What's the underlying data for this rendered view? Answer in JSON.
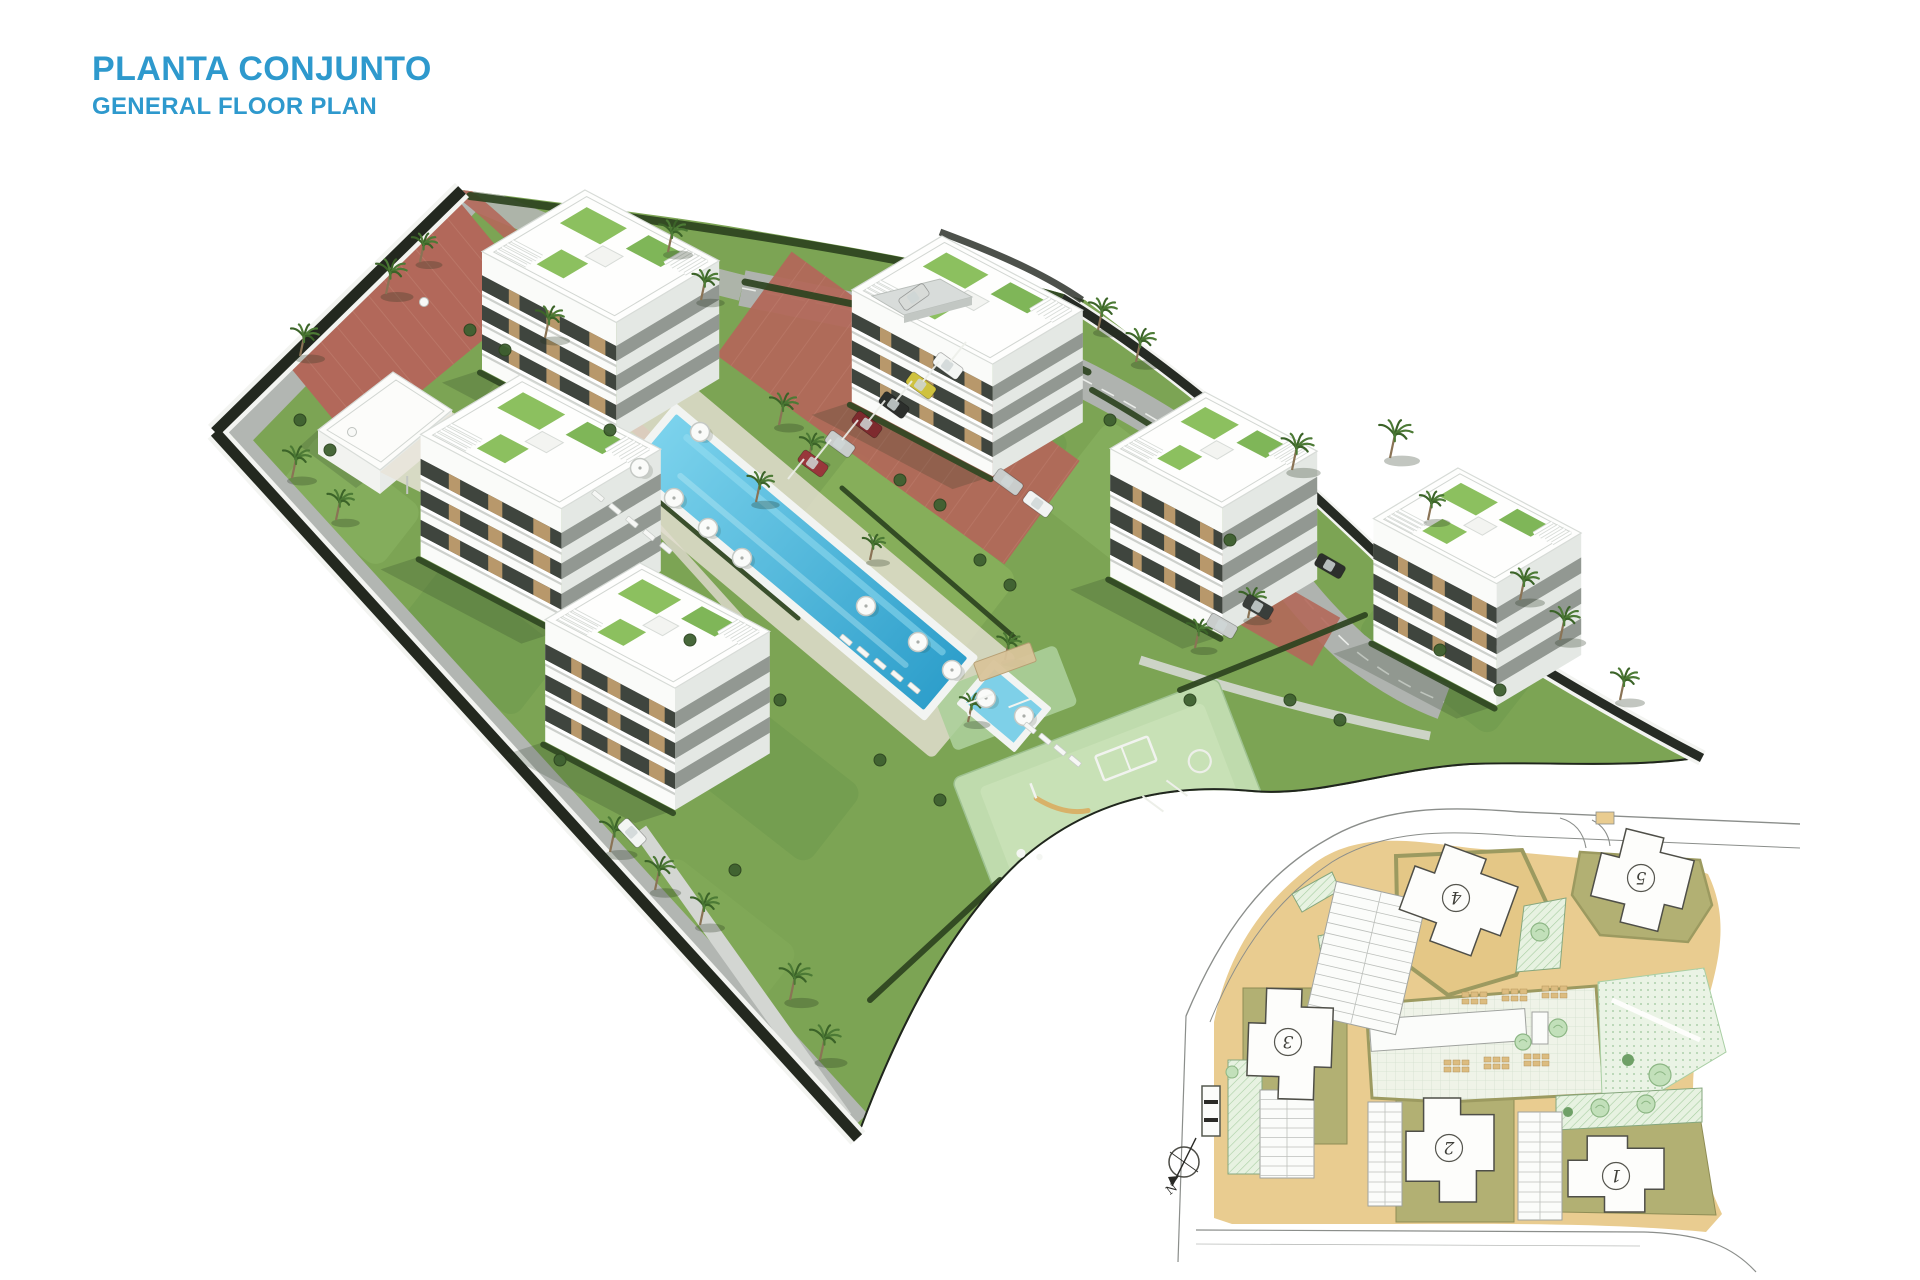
{
  "page": {
    "title": "PLANTA CONJUNTO",
    "subtitle": "GENERAL FLOOR PLAN"
  },
  "colors": {
    "accent_blue": "#2E99CD",
    "grass_green": "#7CA454",
    "pool_blue": "#3FB0DC",
    "brick_red": "#B2685A",
    "plan_tan": "#E9CC90",
    "plan_olive": "#B2B073"
  },
  "site_plan": {
    "compass_label": "N",
    "buildings": [
      {
        "label": "1"
      },
      {
        "label": "2"
      },
      {
        "label": "3"
      },
      {
        "label": "4"
      },
      {
        "label": "5"
      }
    ]
  }
}
